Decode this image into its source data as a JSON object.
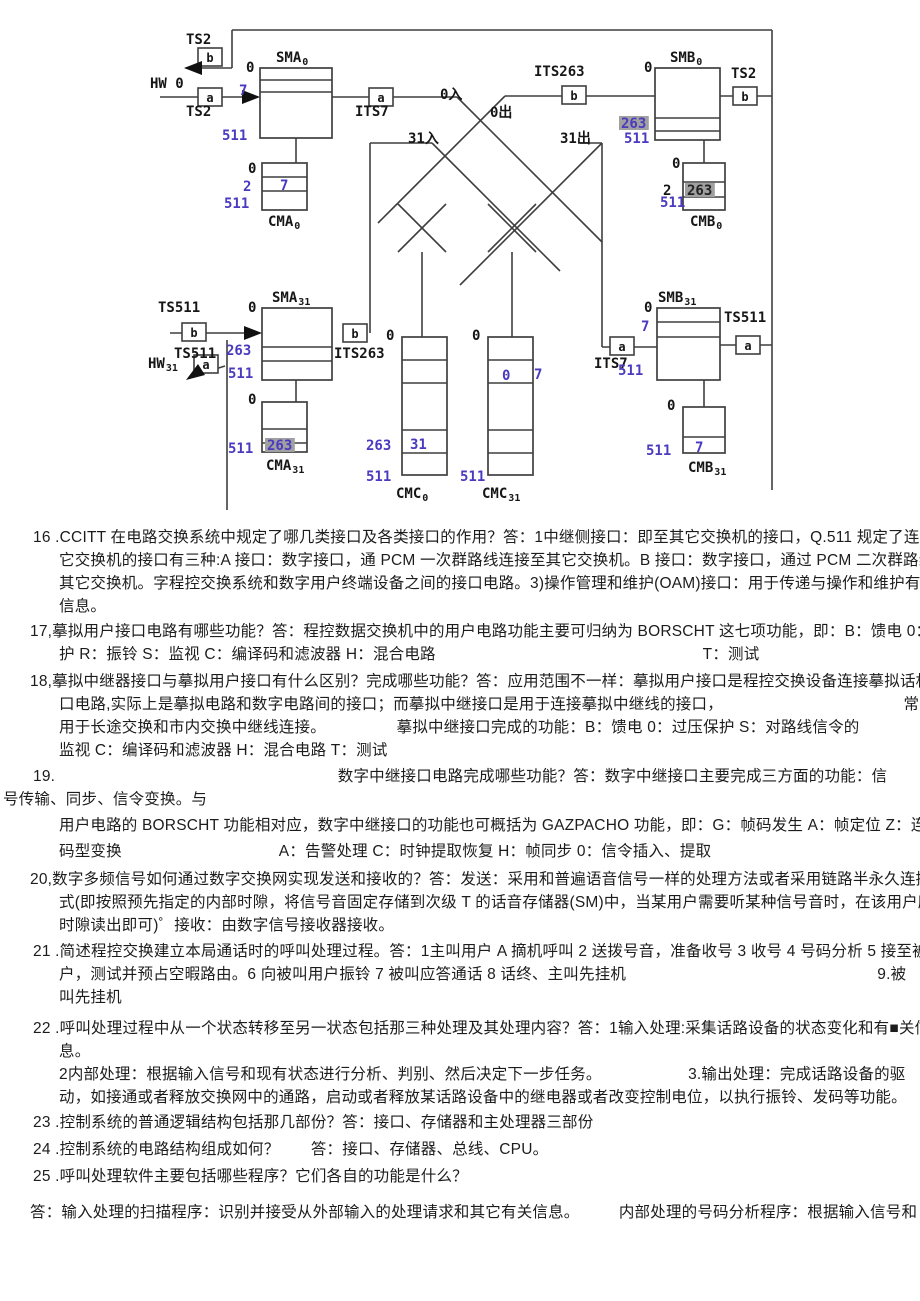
{
  "page": {
    "width": 920,
    "height": 1301,
    "bg": "#ffffff"
  },
  "colors": {
    "line": "#3f3f3f",
    "black": "#161616",
    "blue": "#4a3ac0",
    "dark": "#222222",
    "highlight": "#a0a0a0"
  },
  "diagram": {
    "blocks": [
      {
        "name": "SMA0",
        "x": 260,
        "y": 68,
        "w": 72,
        "h": 70,
        "div": [
          80,
          92
        ]
      },
      {
        "name": "CMA0",
        "x": 262,
        "y": 163,
        "w": 45,
        "h": 47,
        "div": [
          177,
          191
        ]
      },
      {
        "name": "SMB0",
        "x": 655,
        "y": 68,
        "w": 65,
        "h": 72,
        "div": [
          118,
          131
        ]
      },
      {
        "name": "CMB0",
        "x": 683,
        "y": 163,
        "w": 42,
        "h": 47,
        "div": [
          182,
          197
        ]
      },
      {
        "name": "SMA31",
        "x": 262,
        "y": 308,
        "w": 70,
        "h": 72,
        "div": [
          347,
          361
        ]
      },
      {
        "name": "CMA31",
        "x": 262,
        "y": 402,
        "w": 45,
        "h": 50,
        "div": [
          429,
          443
        ]
      },
      {
        "name": "SMB31",
        "x": 657,
        "y": 308,
        "w": 63,
        "h": 72,
        "div": [
          322,
          337
        ]
      },
      {
        "name": "CMB31",
        "x": 683,
        "y": 407,
        "w": 42,
        "h": 46,
        "div": [
          437
        ]
      },
      {
        "name": "CMC0",
        "x": 402,
        "y": 337,
        "w": 45,
        "h": 138,
        "div": [
          360,
          383,
          430,
          453
        ]
      },
      {
        "name": "CMC31",
        "x": 488,
        "y": 337,
        "w": 45,
        "h": 138,
        "div": [
          360,
          383,
          430,
          453
        ]
      }
    ],
    "lines": [
      [
        232,
        30,
        772,
        30
      ],
      [
        772,
        30,
        772,
        96
      ],
      [
        232,
        30,
        232,
        68
      ],
      [
        232,
        68,
        186,
        68
      ],
      [
        160,
        97,
        258,
        97
      ],
      [
        332,
        97,
        457,
        97
      ],
      [
        457,
        97,
        602,
        242
      ],
      [
        505,
        96,
        655,
        96
      ],
      [
        505,
        96,
        398,
        203
      ],
      [
        398,
        203,
        378,
        223
      ],
      [
        720,
        96,
        772,
        96
      ],
      [
        296,
        138,
        296,
        163
      ],
      [
        704,
        140,
        704,
        163
      ],
      [
        370,
        143,
        432,
        143
      ],
      [
        432,
        143,
        560,
        271
      ],
      [
        370,
        143,
        370,
        333
      ],
      [
        580,
        143,
        602,
        143
      ],
      [
        602,
        143,
        460,
        285
      ],
      [
        602,
        143,
        602,
        347
      ],
      [
        602,
        347,
        657,
        347
      ],
      [
        720,
        345,
        772,
        345
      ],
      [
        772,
        96,
        772,
        490
      ],
      [
        704,
        380,
        704,
        407
      ],
      [
        296,
        380,
        296,
        402
      ],
      [
        170,
        333,
        246,
        333
      ],
      [
        227,
        340,
        227,
        510
      ],
      [
        225,
        366,
        196,
        375
      ],
      [
        422,
        252,
        422,
        337
      ],
      [
        512,
        252,
        512,
        337
      ],
      [
        398,
        204,
        446,
        252
      ],
      [
        446,
        204,
        398,
        252
      ],
      [
        488,
        204,
        536,
        252
      ],
      [
        536,
        204,
        488,
        252
      ]
    ],
    "arrows": [
      {
        "name": "arrow-left-hw0",
        "pts": "184,68 202,61 202,75"
      },
      {
        "name": "arrow-into-sma0",
        "pts": "260,97 242,90 242,104"
      },
      {
        "name": "arrow-into-sma31",
        "pts": "262,333 244,326 244,340"
      },
      {
        "name": "arrow-hw31",
        "pts": "186,380 205,375 198,364"
      }
    ],
    "small_boxes": [
      {
        "x": 198,
        "y": 48,
        "l": "b"
      },
      {
        "x": 198,
        "y": 88,
        "l": "a"
      },
      {
        "x": 369,
        "y": 88,
        "l": "a"
      },
      {
        "x": 562,
        "y": 86,
        "l": "b"
      },
      {
        "x": 733,
        "y": 87,
        "l": "b"
      },
      {
        "x": 182,
        "y": 323,
        "l": "b"
      },
      {
        "x": 194,
        "y": 355,
        "l": "a"
      },
      {
        "x": 343,
        "y": 324,
        "l": "b"
      },
      {
        "x": 610,
        "y": 337,
        "l": "a"
      },
      {
        "x": 736,
        "y": 336,
        "l": "a"
      }
    ],
    "labels": [
      {
        "t": "TS2",
        "x": 186,
        "y": 44
      },
      {
        "t": "HW 0",
        "x": 150,
        "y": 88
      },
      {
        "t": "TS2",
        "x": 186,
        "y": 116
      },
      {
        "t": "SMA",
        "sub": "0",
        "x": 276,
        "y": 62
      },
      {
        "t": "ITS7",
        "x": 355,
        "y": 116
      },
      {
        "t": "0入",
        "x": 440,
        "y": 99
      },
      {
        "t": "0出",
        "x": 490,
        "y": 117
      },
      {
        "t": "31入",
        "x": 408,
        "y": 143
      },
      {
        "t": "31出",
        "x": 560,
        "y": 143
      },
      {
        "t": "ITS263",
        "x": 534,
        "y": 76
      },
      {
        "t": "SMB",
        "sub": "0",
        "x": 670,
        "y": 62
      },
      {
        "t": "TS2",
        "x": 731,
        "y": 78
      },
      {
        "t": "0",
        "x": 246,
        "y": 72
      },
      {
        "t": "0",
        "x": 248,
        "y": 173
      },
      {
        "t": "CMA",
        "sub": "0",
        "x": 268,
        "y": 226
      },
      {
        "t": "0",
        "x": 644,
        "y": 72
      },
      {
        "t": "0",
        "x": 672,
        "y": 168
      },
      {
        "t": "2",
        "x": 663,
        "y": 195
      },
      {
        "t": "CMB",
        "sub": "0",
        "x": 690,
        "y": 226
      },
      {
        "t": "SMA",
        "sub": "31",
        "x": 272,
        "y": 302
      },
      {
        "t": "TS511",
        "x": 158,
        "y": 312
      },
      {
        "t": "TS511",
        "x": 174,
        "y": 358
      },
      {
        "t": "HW",
        "sub": "31",
        "x": 148,
        "y": 368
      },
      {
        "t": "ITS263",
        "x": 334,
        "y": 358
      },
      {
        "t": "0",
        "x": 248,
        "y": 312
      },
      {
        "t": "0",
        "x": 248,
        "y": 404
      },
      {
        "t": "CMA",
        "sub": "31",
        "x": 266,
        "y": 470
      },
      {
        "t": "SMB",
        "sub": "31",
        "x": 658,
        "y": 302
      },
      {
        "t": "TS511",
        "x": 724,
        "y": 322
      },
      {
        "t": "ITS7",
        "x": 594,
        "y": 368
      },
      {
        "t": "0",
        "x": 644,
        "y": 312
      },
      {
        "t": "0",
        "x": 667,
        "y": 410
      },
      {
        "t": "CMB",
        "sub": "31",
        "x": 688,
        "y": 472
      },
      {
        "t": "0",
        "x": 386,
        "y": 340
      },
      {
        "t": "CMC",
        "sub": "0",
        "x": 396,
        "y": 498
      },
      {
        "t": "0",
        "x": 472,
        "y": 340
      },
      {
        "t": "CMC",
        "sub": "31",
        "x": 482,
        "y": 498
      },
      {
        "t": "7",
        "x": 239,
        "y": 95,
        "c": "blue"
      },
      {
        "t": "511",
        "x": 222,
        "y": 140,
        "c": "blue"
      },
      {
        "t": "2",
        "x": 243,
        "y": 191,
        "c": "blue"
      },
      {
        "t": "7",
        "x": 280,
        "y": 190,
        "c": "blue"
      },
      {
        "t": "511",
        "x": 224,
        "y": 208,
        "c": "blue"
      },
      {
        "t": "263",
        "x": 621,
        "y": 128,
        "c": "blue",
        "hl": 1
      },
      {
        "t": "511",
        "x": 624,
        "y": 143,
        "c": "blue"
      },
      {
        "t": "511",
        "x": 660,
        "y": 207,
        "c": "blue"
      },
      {
        "t": "263",
        "x": 687,
        "y": 195,
        "c": "dark",
        "hl": 1
      },
      {
        "t": "263",
        "x": 226,
        "y": 355,
        "c": "blue"
      },
      {
        "t": "511",
        "x": 228,
        "y": 378,
        "c": "blue"
      },
      {
        "t": "511",
        "x": 228,
        "y": 453,
        "c": "blue"
      },
      {
        "t": "263",
        "x": 267,
        "y": 450,
        "c": "blue",
        "hl": 1
      },
      {
        "t": "263",
        "x": 366,
        "y": 450,
        "c": "blue"
      },
      {
        "t": "31",
        "x": 410,
        "y": 449,
        "c": "blue"
      },
      {
        "t": "511",
        "x": 366,
        "y": 481,
        "c": "blue"
      },
      {
        "t": "511",
        "x": 460,
        "y": 481,
        "c": "blue"
      },
      {
        "t": "0",
        "x": 502,
        "y": 380,
        "c": "blue"
      },
      {
        "t": "7",
        "x": 534,
        "y": 379,
        "c": "blue"
      },
      {
        "t": "7",
        "x": 641,
        "y": 331,
        "c": "blue"
      },
      {
        "t": "511",
        "x": 618,
        "y": 375,
        "c": "blue"
      },
      {
        "t": "511",
        "x": 646,
        "y": 455,
        "c": "blue"
      },
      {
        "t": "7",
        "x": 695,
        "y": 452,
        "c": "blue"
      }
    ]
  },
  "text": {
    "lines": [
      {
        "x": 33,
        "y": 527,
        "t": "16 .CCITT 在电路交换系统中规定了哪几类接口及各类接口的作用？答：1中继侧接口：即至其它交换机的接口，Q.511 规定了连接到其"
      },
      {
        "x": 59,
        "y": 550,
        "t": "它交换机的接口有三种:A 接口：数字接口，通 PCM 一次群路线连接至其它交换机。B 接口：数字接口，通过 PCM 二次群路线连接"
      },
      {
        "x": 59,
        "y": 573,
        "t": "其它交换机。字程控交换系统和数字用户终端设备之间的接口电路。3)操作管理和维护(OAM)接口：用于传递与操作和维护有关的"
      },
      {
        "x": 59,
        "y": 596,
        "t": "信息。"
      },
      {
        "x": 30,
        "y": 621,
        "t": "17,摹拟用户接口电路有哪些功能？答：程控数据交换机中的用户电路功能主要可归纳为 BORSCHT 这七项功能，即：B：馈电 0：过压保"
      },
      {
        "x": 59,
        "y": 644,
        "t": "护 R：振铃 S：监视 C：编译码和滤波器 H：混合电路　　　　　　　　　　　　　　　　　T：测试"
      },
      {
        "x": 30,
        "y": 671,
        "t": "18,摹拟中继器接口与摹拟用户接口有什么区别？完成哪些功能？答：应用范围不一样：摹拟用户接口是程控交换设备连接摹拟话机的接"
      },
      {
        "x": 59,
        "y": 694,
        "t": "口电路,实际上是摹拟电路和数字电路间的接口；而摹拟中继接口是用于连接摹拟中继线的接口，　　　　　　　　　　　　常"
      },
      {
        "x": 59,
        "y": 717,
        "t": "用于长途交换和市内交换中继线连接。　　　　　摹拟中继接口完成的功能：B：馈电 0：过压保护 S：对路线信令的"
      },
      {
        "x": 59,
        "y": 740,
        "t": "监视 C：编译码和滤波器 H：混合电路 T：测试"
      },
      {
        "x": 33,
        "y": 766,
        "t": "19.　　　　　　　　　　　　　　　　　　数字中继接口电路完成哪些功能？答：数字中继接口主要完成三方面的功能：信"
      },
      {
        "x": 3,
        "y": 789,
        "t": "号传输、同步、信令变换。与"
      },
      {
        "x": 59,
        "y": 815,
        "t": "用户电路的 BORSCHT 功能相对应，数字中继接口的功能也可概括为 GAZPACHO 功能，即：G：帧码发生 A：帧定位 Z：连零抑制 P："
      },
      {
        "x": 59,
        "y": 841,
        "t": "码型变换　　　　　　　　　　A：告警处理 C：时钟提取恢复 H：帧同步 0：信令插入、提取"
      },
      {
        "x": 30,
        "y": 869,
        "t": "20,数字多频信号如何通过数字交换网实现发送和接收的？答：发送：采用和普遍语音信号一样的处理方法或者采用链路半永久连接方"
      },
      {
        "x": 59,
        "y": 892,
        "t": "式(即按照预先指定的内部时隙，将信号音固定存储到次级 T 的话音存储器(SM)中，当某用户需要听某种信号音时，在该用户所在"
      },
      {
        "x": 59,
        "y": 915,
        "t": "时隙读出即可)゜接收：由数字信号接收器接收。"
      },
      {
        "x": 33,
        "y": 941,
        "t": "21 .简述程控交换建立本局通话时的呼叫处理过程。答：1主叫用户 A 摘机呼叫 2 送拨号音，准备收号 3 收号 4 号码分析 5 接至被叫用"
      },
      {
        "x": 59,
        "y": 964,
        "t": "户，测试并预占空暇路由。6 向被叫用户振铃 7 被叫应答通话 8 话终、主叫先挂机　　　　　　　　　　　　　　　　9.被"
      },
      {
        "x": 59,
        "y": 987,
        "t": "叫先挂机"
      },
      {
        "x": 33,
        "y": 1018,
        "t": "22 .呼叫处理过程中从一个状态转移至另一状态包括那三种处理及其处理内容？答：1输入处理:采集话路设备的状态变化和有■关信"
      },
      {
        "x": 59,
        "y": 1041,
        "t": "息。"
      },
      {
        "x": 59,
        "y": 1064,
        "t": "2内部处理：根据输入信号和现有状态进行分析、判别、然后决定下一步任务。　　　　　　3.输出处理：完成话路设备的驱"
      },
      {
        "x": 59,
        "y": 1087,
        "t": "动，如接通或者释放交换网中的通路，启动或者释放某话路设备中的继电器或者改变控制电位，以执行振铃、发码等功能。"
      },
      {
        "x": 33,
        "y": 1112,
        "t": "23 .控制系统的普通逻辑结构包括那几部份？答：接口、存储器和主处理器三部份"
      },
      {
        "x": 33,
        "y": 1139,
        "t": "24 .控制系统的电路结构组成如何？　　答：接口、存储器、总线、CPU。"
      },
      {
        "x": 33,
        "y": 1166,
        "t": "25 .呼叫处理软件主要包括哪些程序？它们各自的功能是什么？"
      },
      {
        "x": 30,
        "y": 1202,
        "t": "答：输入处理的扫描程序：识别并接受从外部输入的处理请求和其它有关信息。　　　内部处理的号码分析程序：根据输入信号和"
      }
    ]
  }
}
